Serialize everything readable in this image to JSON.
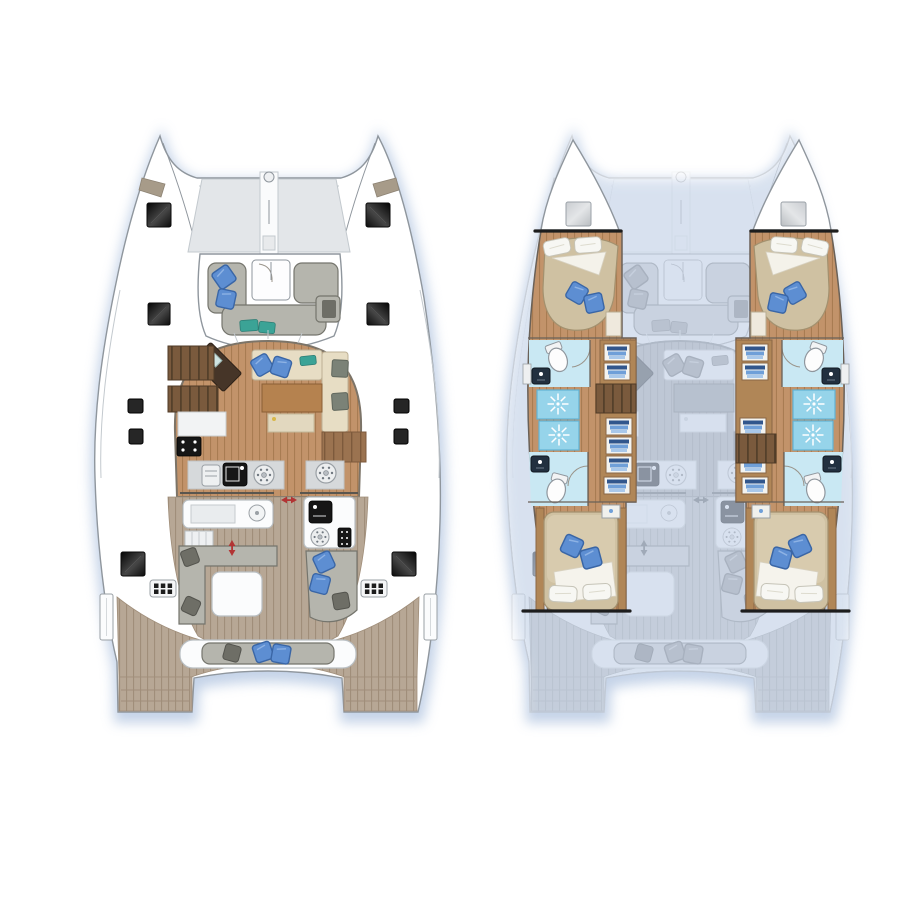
{
  "scene": {
    "type": "catamaran-floor-plan-illustration",
    "background": "#ffffff",
    "views": [
      {
        "id": "deck-plan",
        "side": "left",
        "style": "full-color"
      },
      {
        "id": "hull-plan",
        "side": "right",
        "style": "hull-interiors-sharp-over-ghosted-deck"
      }
    ]
  },
  "colors": {
    "outline": "#8f969d",
    "outline_light": "#c3c9ce",
    "trampoline": "#e3e6e9",
    "wood": "#c2936a",
    "wood_line": "#a87c52",
    "slat": "#7a5a3d",
    "slat_line": "#55402b",
    "plank": "#9b7350",
    "plank_line": "#7d5a3c",
    "table_wood": "#b5824f",
    "beige": "#e7ddc4",
    "beige_line": "#bdb095",
    "sofa": "#b5b5ad",
    "sofa_line": "#75756d",
    "pillow_dark": "#6e6e66",
    "blue": "#5d8ed2",
    "blue_dark": "#3a66a6",
    "teal": "#3ba396",
    "counter": "#d6d9db",
    "appliance": "#161616",
    "taupe": "#b7a795",
    "taupe_line": "#a08e7a",
    "bed": "#cfc1a2",
    "bed_line": "#a3916f",
    "duvet": "#d9ccb0",
    "white_soft": "#f7f7f3",
    "cyan_floor": "#c9e8f3",
    "cyan": "#96d4ea",
    "cyan_line": "#62b2d4",
    "navy": "#31568c",
    "mid_blue": "#6f9fd8",
    "light_blue": "#a9c8ea",
    "wardrobe": "#b08657",
    "red": "#b23434",
    "cut": "#1d1d1d",
    "shadow": "#b6c8e2",
    "window_tint": "#a79b89"
  },
  "deck_plan": {
    "bow": {
      "trampoline": true,
      "forestay_ring": true,
      "anchor_locker": true,
      "bow_windows": 2,
      "black_deck_hatches": 6,
      "small_deck_fittings": 4,
      "vent_grilles": 2,
      "boarding_gates": 2
    },
    "forward_cockpit": {
      "u_shaped_lounge": true,
      "blue_pillows": 2,
      "teal_cushions": 2,
      "foredeck_door_with_swing": true
    },
    "saloon": {
      "nav_desk_angled": true,
      "sofa_blue_pillows": 2,
      "teal_cushion": 1,
      "gray_cushions": 2,
      "dining_table": true,
      "ottoman_seat": true,
      "companionway_stair_runs": 2,
      "slatted_bench": true
    },
    "galley": {
      "cooktop_burners": 4,
      "black_sink": 1,
      "round_hob_elements": 2,
      "front_counter_segments": 2,
      "appliance_front": true
    },
    "aft_cockpit": {
      "wet_bar_with_sink": true,
      "side_steps": true,
      "l_sofa": true,
      "dark_pillows": 3,
      "coffee_table": true,
      "chaise_blue_pillows": 2,
      "outdoor_galley": {
        "sink": true,
        "round_burner": true,
        "grill_front": true
      },
      "sliding_door_arrow": "horizontal",
      "locker_arrow": "vertical"
    },
    "stern": {
      "aft_bench_blue_pillows": 2,
      "aft_bench_dark_pillow": 1,
      "swim_platform_wings": 2,
      "transom_steps_per_wing": 2
    }
  },
  "hull_plan": {
    "ghost_deck_overlay": true,
    "port_hull": {
      "bow_deck_hatch_gray": 1,
      "forward_cabin": {
        "island_double_bed": true,
        "white_pillows": 2,
        "blue_pillows": 2,
        "duvet_fold": true,
        "side_shelf": true
      },
      "forward_bathroom": {
        "toilet": true,
        "basin": true,
        "door_swings": 2
      },
      "shower_stalls_with_sunburst": 2,
      "wardrobe_cells_with_folded_clothes": 6,
      "companionway_stairs": true,
      "aft_bathroom": {
        "toilet": true,
        "basin": true
      },
      "aft_cabin": {
        "double_bed": true,
        "white_pillows": 2,
        "blue_pillows": 2,
        "duvet_fold": true,
        "nightstand": true
      },
      "hull_cut_lines": 2
    },
    "starboard_hull": {
      "mirror_of_port": true,
      "companionway_stairs_offset_aft": true
    }
  }
}
